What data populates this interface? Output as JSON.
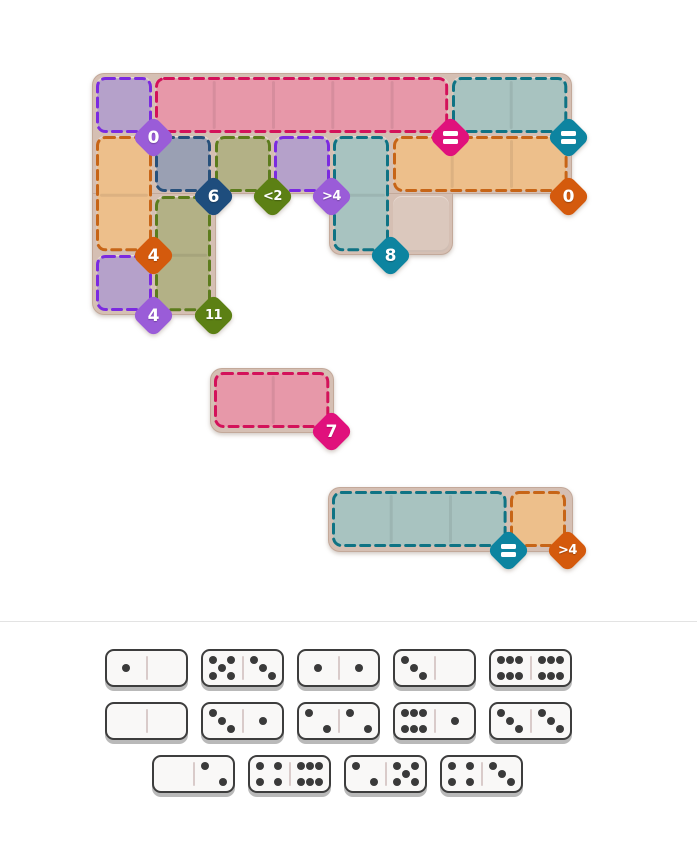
{
  "palette": {
    "page_bg": "#ffffff",
    "board_backing": "#d5bfb3",
    "cell_tile": "#dbc8bd",
    "divider_line": "#e3e3e3",
    "region_divider": "rgba(0,0,0,0.07)",
    "regions": {
      "purple": {
        "fill": "#b5a1ca",
        "border": "#7b2ae0"
      },
      "pink": {
        "fill": "#e798a9",
        "border": "#d3125a"
      },
      "teal": {
        "fill": "#a8c3c0",
        "border": "#0f7384"
      },
      "orange": {
        "fill": "#edbf8b",
        "border": "#c76517"
      },
      "navy": {
        "fill": "#9aa0b3",
        "border": "#27507b"
      },
      "olive": {
        "fill": "#b3b186",
        "border": "#5c7c1d"
      }
    },
    "badges": {
      "purple": "#9a5cd8",
      "magenta": "#e0117c",
      "teal": "#0d84a0",
      "navy": "#1e4d7d",
      "olive": "#5c8014",
      "orange": "#d45a0d"
    },
    "domino": {
      "bg": "#f9f8f7",
      "border": "#3d3d3d",
      "base_shadow": "#b9b9b9",
      "pip": "#3a3a3a",
      "divider": "#d9cbca"
    }
  },
  "board": {
    "grid": {
      "x": 96,
      "y": 77,
      "cell": 56,
      "pitch": 59.3
    },
    "backing_rects": [
      {
        "x": 92,
        "y": 73,
        "w": 480,
        "h": 121,
        "radius": "12px 12px 12px 0"
      },
      {
        "x": 92,
        "y": 193,
        "w": 123.5,
        "h": 122,
        "radius": "0 0 12px 12px"
      },
      {
        "x": 329,
        "y": 193,
        "w": 123.5,
        "h": 62,
        "radius": "0 0 12px 12px"
      }
    ],
    "cells": [
      [
        0,
        0
      ],
      [
        1,
        0
      ],
      [
        2,
        0
      ],
      [
        3,
        0
      ],
      [
        4,
        0
      ],
      [
        5,
        0
      ],
      [
        6,
        0
      ],
      [
        7,
        0
      ],
      [
        0,
        1
      ],
      [
        1,
        1
      ],
      [
        2,
        1
      ],
      [
        3,
        1
      ],
      [
        4,
        1
      ],
      [
        5,
        1
      ],
      [
        6,
        1
      ],
      [
        7,
        1
      ],
      [
        0,
        2
      ],
      [
        1,
        2
      ],
      [
        4,
        2
      ],
      [
        5,
        2
      ],
      [
        0,
        3
      ],
      [
        1,
        3
      ]
    ],
    "regions": [
      {
        "name": "region-purple-a",
        "color": "purple",
        "col": 0,
        "row": 0,
        "cols": 1,
        "rows": 1
      },
      {
        "name": "region-pink-a",
        "color": "pink",
        "col": 1,
        "row": 0,
        "cols": 5,
        "rows": 1
      },
      {
        "name": "region-teal-a",
        "color": "teal",
        "col": 6,
        "row": 0,
        "cols": 2,
        "rows": 1
      },
      {
        "name": "region-orange-a",
        "color": "orange",
        "col": 0,
        "row": 1,
        "cols": 1,
        "rows": 2
      },
      {
        "name": "region-navy-a",
        "color": "navy",
        "col": 1,
        "row": 1,
        "cols": 1,
        "rows": 1
      },
      {
        "name": "region-olive-a",
        "color": "olive",
        "col": 2,
        "row": 1,
        "cols": 1,
        "rows": 1
      },
      {
        "name": "region-purple-b",
        "color": "purple",
        "col": 3,
        "row": 1,
        "cols": 1,
        "rows": 1
      },
      {
        "name": "region-teal-b",
        "color": "teal",
        "col": 4,
        "row": 1,
        "cols": 1,
        "rows": 2
      },
      {
        "name": "region-orange-b",
        "color": "orange",
        "col": 5,
        "row": 1,
        "cols": 3,
        "rows": 1
      },
      {
        "name": "region-olive-b",
        "color": "olive",
        "col": 1,
        "row": 2,
        "cols": 1,
        "rows": 2
      },
      {
        "name": "region-purple-c",
        "color": "purple",
        "col": 0,
        "row": 3,
        "cols": 1,
        "rows": 1
      }
    ],
    "badges": [
      {
        "name": "badge-0-purple",
        "label": "0",
        "color": "purple",
        "corner": [
          1,
          1
        ]
      },
      {
        "name": "badge-equals-magenta",
        "label": "=",
        "color": "magenta",
        "corner": [
          6,
          1
        ]
      },
      {
        "name": "badge-equals-teal",
        "label": "=",
        "color": "teal",
        "corner": [
          8,
          1
        ]
      },
      {
        "name": "badge-6-navy",
        "label": "6",
        "color": "navy",
        "corner": [
          2,
          2
        ]
      },
      {
        "name": "badge-lt2-olive",
        "label": "<2",
        "color": "olive",
        "corner": [
          3,
          2
        ]
      },
      {
        "name": "badge-gt4-purple",
        "label": ">4",
        "color": "purple",
        "corner": [
          4,
          2
        ]
      },
      {
        "name": "badge-0-orange",
        "label": "0",
        "color": "orange",
        "corner": [
          8,
          2
        ]
      },
      {
        "name": "badge-4-orange",
        "label": "4",
        "color": "orange",
        "corner": [
          1,
          3
        ]
      },
      {
        "name": "badge-8-teal",
        "label": "8",
        "color": "teal",
        "corner": [
          5,
          3
        ]
      },
      {
        "name": "badge-4-purple",
        "label": "4",
        "color": "purple",
        "corner": [
          1,
          4
        ]
      },
      {
        "name": "badge-11-olive",
        "label": "11",
        "color": "olive",
        "corner": [
          2,
          4
        ]
      }
    ]
  },
  "pieces": [
    {
      "name": "piece-pink",
      "x": 210,
      "y": 368,
      "w": 123.5,
      "h": 65,
      "regions": [
        {
          "color": "pink",
          "dx": 4,
          "dy": 4,
          "cols": 2,
          "rows": 1
        }
      ],
      "badges": [
        {
          "name": "badge-7-magenta",
          "label": "7",
          "color": "magenta",
          "dx": 121,
          "dy": 63
        }
      ]
    },
    {
      "name": "piece-teal-orange",
      "x": 328,
      "y": 487,
      "w": 245,
      "h": 65,
      "regions": [
        {
          "color": "teal",
          "dx": 4,
          "dy": 4,
          "cols": 3,
          "rows": 1
        },
        {
          "color": "orange",
          "dx": 181.9,
          "dy": 4,
          "cols": 1,
          "rows": 1
        }
      ],
      "badges": [
        {
          "name": "badge-equals-teal-2",
          "label": "=",
          "color": "teal",
          "dx": 180,
          "dy": 63
        },
        {
          "name": "badge-gt4-orange",
          "label": ">4",
          "color": "orange",
          "dx": 239.4,
          "dy": 63
        }
      ]
    }
  ],
  "divider": {
    "y": 621
  },
  "tray": {
    "domino_w": 83,
    "domino_h": 38,
    "gap": 13,
    "rows": [
      {
        "y": 649,
        "x": 105,
        "dominoes": [
          [
            1,
            0
          ],
          [
            5,
            3
          ],
          [
            1,
            1
          ],
          [
            3,
            0
          ],
          [
            6,
            6
          ]
        ]
      },
      {
        "y": 702,
        "x": 105,
        "dominoes": [
          [
            0,
            0
          ],
          [
            3,
            1
          ],
          [
            2,
            2
          ],
          [
            6,
            1
          ],
          [
            3,
            3
          ]
        ]
      },
      {
        "y": 755,
        "x": 152,
        "dominoes": [
          [
            0,
            2
          ],
          [
            4,
            6
          ],
          [
            2,
            5
          ],
          [
            4,
            3
          ]
        ]
      }
    ]
  }
}
